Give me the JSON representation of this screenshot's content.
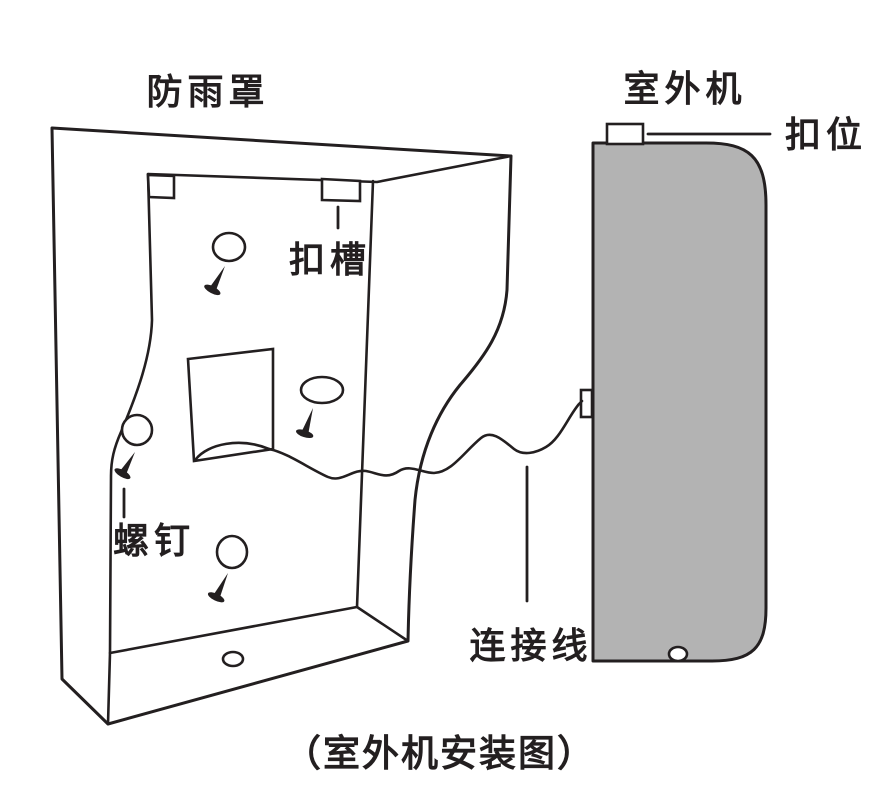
{
  "figure": {
    "caption": "（室外机安装图）",
    "labels": {
      "rain_cover": "防雨罩",
      "outdoor_unit": "室外机",
      "buckle_tab": "扣位",
      "buckle_slot": "扣槽",
      "screw": "螺钉",
      "cable": "连接线"
    },
    "colors": {
      "line": "#231f20",
      "unit_fill": "#b3b3b3",
      "background": "#ffffff"
    }
  }
}
